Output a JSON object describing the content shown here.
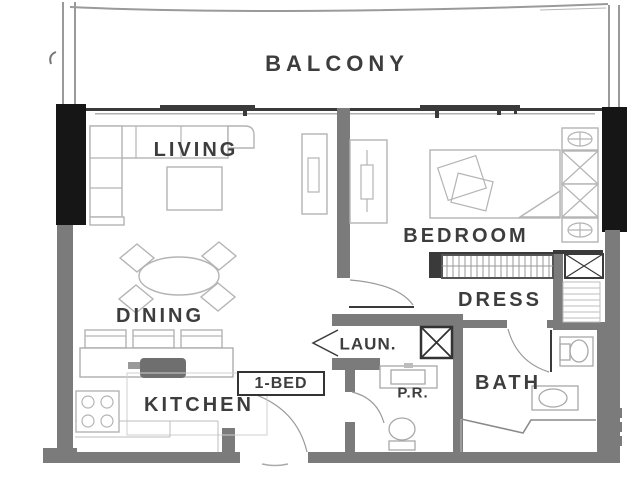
{
  "plan": {
    "unit_label": "1-BED",
    "rooms": {
      "balcony": "BALCONY",
      "living": "LIVING",
      "bedroom": "BEDROOM",
      "dining": "DINING",
      "dress": "DRESS",
      "laundry": "LAUN.",
      "kitchen": "KITCHEN",
      "powder_room": "P.R.",
      "bath": "BATH"
    }
  },
  "colors": {
    "background": "#ffffff",
    "wall-black": "#161616",
    "wall-gray": "#7b7b7b",
    "wall-line": "#3a3a3a",
    "furniture": "#b4b4b4",
    "fixture": "#a8a8a8",
    "label-text": "#3d3d3d"
  }
}
